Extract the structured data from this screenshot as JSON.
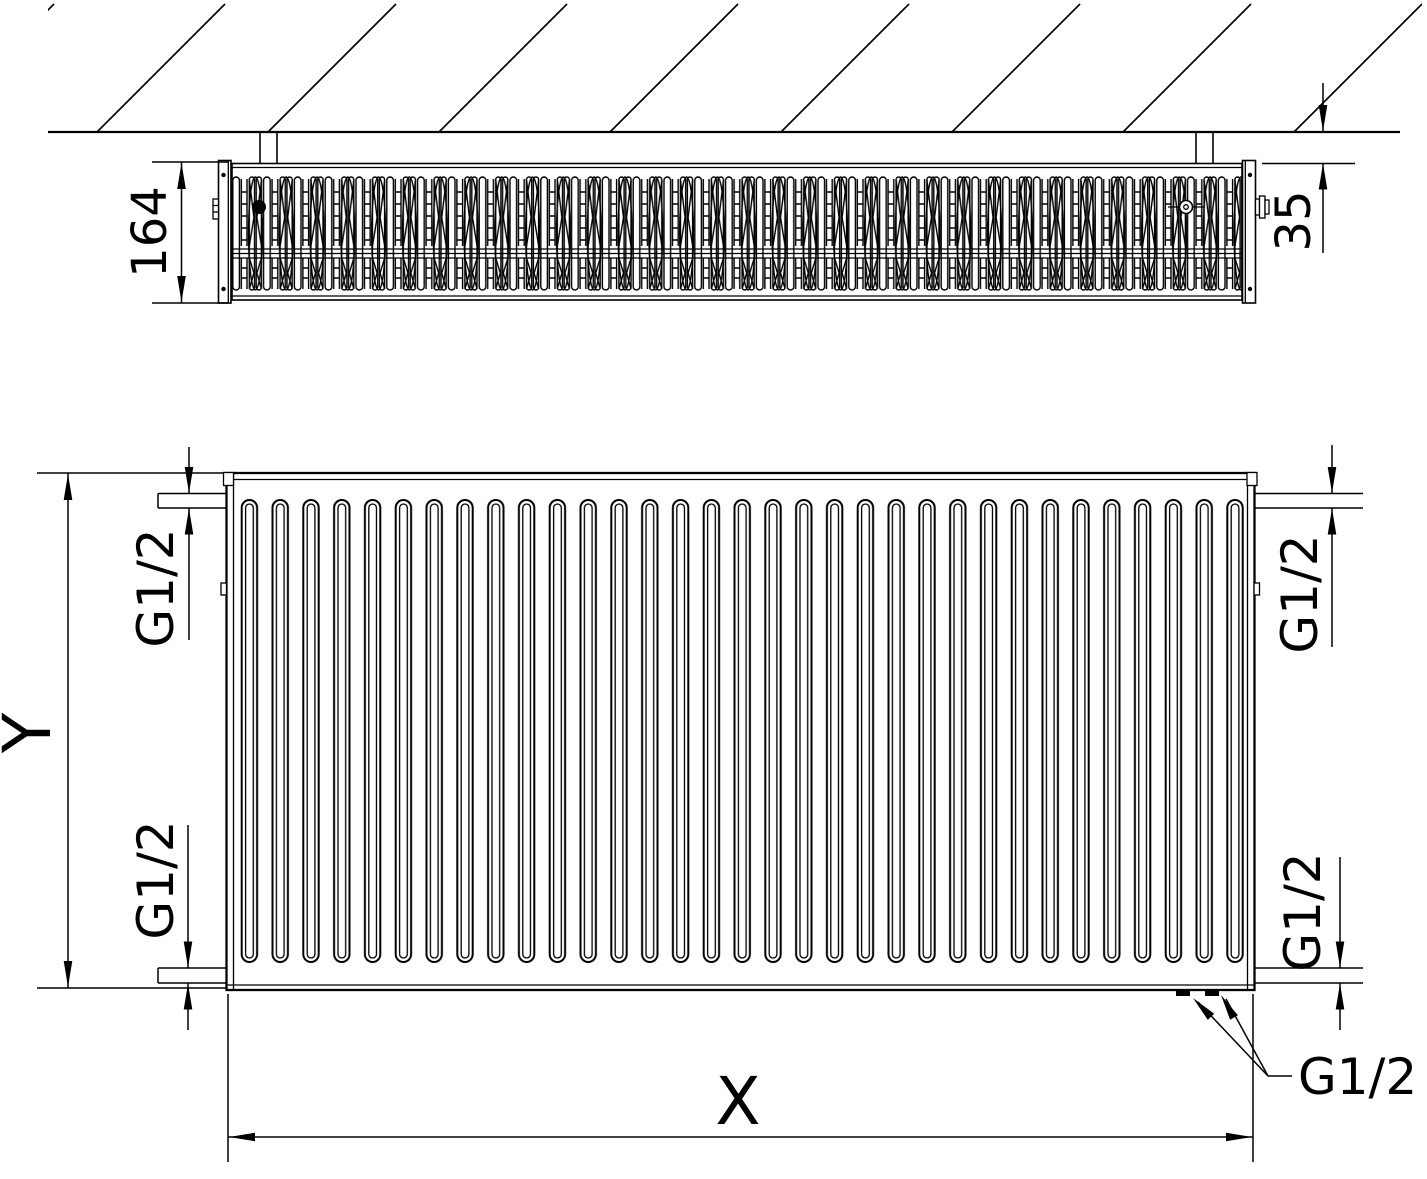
{
  "labels": {
    "top_view": {
      "depth": "164",
      "wall_clearance": "35"
    },
    "front_view": {
      "height": "Y",
      "width": "X",
      "conn_top_left": "G1/2",
      "conn_top_right": "G1/2",
      "conn_bottom_left": "G1/2",
      "conn_bottom_right": "G1/2",
      "conn_bottom_pair": "G1/2"
    }
  },
  "colors": {
    "line": "#000000",
    "background": "#ffffff"
  }
}
